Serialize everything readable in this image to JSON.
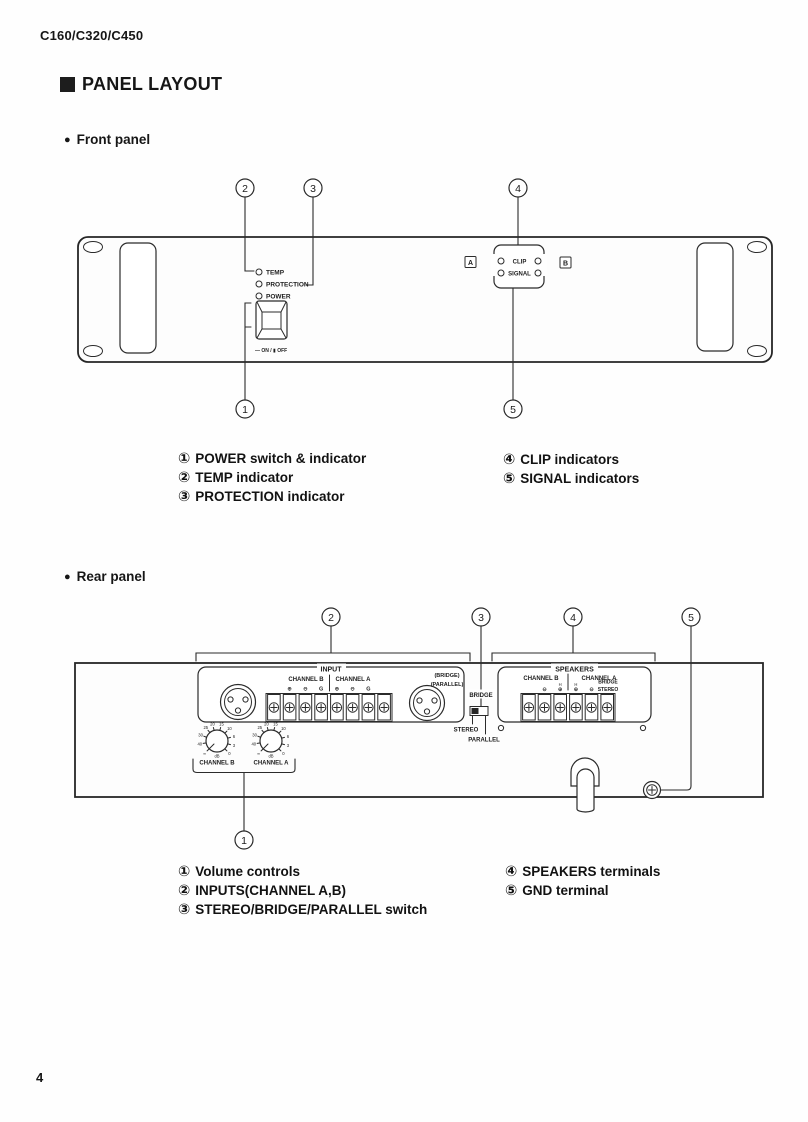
{
  "page": {
    "model": "C160/C320/C450",
    "section_title": "PANEL LAYOUT",
    "bullet": "●",
    "front_heading": "Front panel",
    "rear_heading": "Rear panel",
    "page_number": "4"
  },
  "callouts": {
    "n1": "1",
    "n2": "2",
    "n3": "3",
    "n4": "4",
    "n5": "5"
  },
  "front": {
    "led_temp": "TEMP",
    "led_protection": "PROTECTION",
    "led_power": "POWER",
    "switch_label": "— ON / ▮ OFF",
    "channel_a_badge": "A",
    "channel_b_badge": "B",
    "meter_clip": "CLIP",
    "meter_signal": "SIGNAL",
    "legend": [
      {
        "num": "①",
        "label": "POWER switch & indicator"
      },
      {
        "num": "②",
        "label": "TEMP indicator"
      },
      {
        "num": "③",
        "label": "PROTECTION indicator"
      },
      {
        "num": "④",
        "label": "CLIP indicators"
      },
      {
        "num": "⑤",
        "label": "SIGNAL indicators"
      }
    ]
  },
  "rear": {
    "input_title": "INPUT",
    "input_channel_b": "CHANNEL B",
    "input_channel_a": "CHANNEL A",
    "sym_plus": "⊕",
    "sym_minus": "⊖",
    "sym_g": "G",
    "bridge_paren": "(BRIDGE)",
    "parallel_paren": "(PARALLEL)",
    "vol_channel_b": "CHANNEL B",
    "vol_channel_a": "CHANNEL A",
    "knob_scale": {
      "inf": "∞",
      "v40": "40",
      "v30": "30",
      "v25": "25",
      "v20": "20",
      "v15": "15",
      "v10": "10",
      "v6": "6",
      "v3": "3",
      "v0": "0",
      "db": "dB"
    },
    "sw_bridge": "BRIDGE",
    "sw_stereo": "STEREO",
    "sw_parallel": "PARALLEL",
    "spk_title": "SPEAKERS",
    "spk_channel_b": "CHANNEL B",
    "spk_channel_a": "CHANNEL A",
    "spk_bridge": "BRIDGE",
    "spk_stereo": "STEREO",
    "spk_h": "H",
    "legend": [
      {
        "num": "①",
        "label": "Volume controls"
      },
      {
        "num": "②",
        "label": "INPUTS(CHANNEL A,B)"
      },
      {
        "num": "③",
        "label": "STEREO/BRIDGE/PARALLEL switch"
      },
      {
        "num": "④",
        "label": "SPEAKERS terminals"
      },
      {
        "num": "⑤",
        "label": "GND terminal"
      }
    ]
  }
}
